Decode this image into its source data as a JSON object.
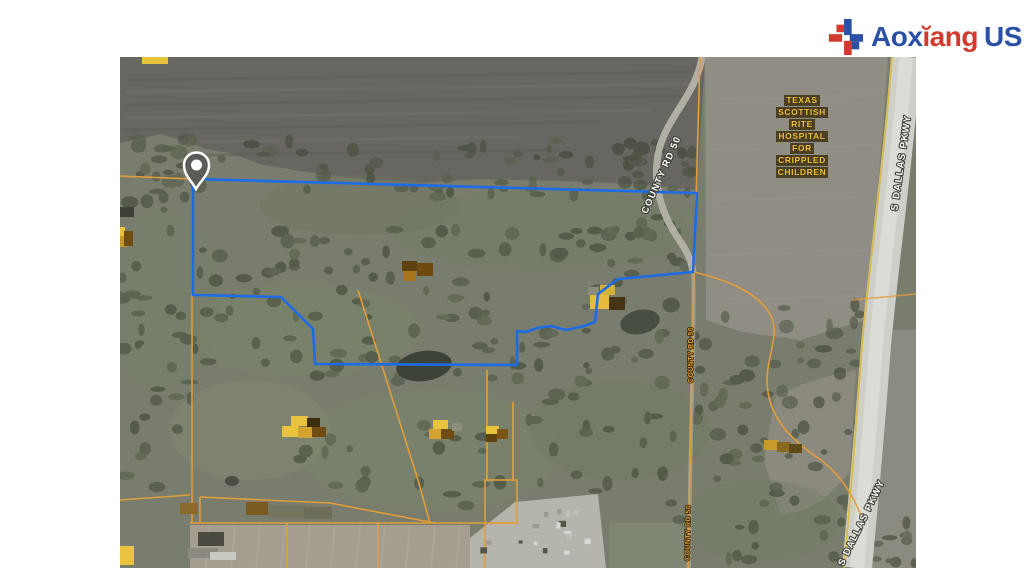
{
  "logo": {
    "part1": "Aox",
    "part2": "ĭang",
    "part3": "US"
  },
  "colors": {
    "brand_blue": "#2a51a5",
    "brand_red": "#d23a2e",
    "boundary_blue": "#1b6ce6",
    "parcel_orange": "#e29e3a",
    "label_yellow": "#f2c238"
  },
  "map": {
    "labels": {
      "hospital_lines": [
        "TEXAS",
        "SCOTTISH",
        "RITE",
        "HOSPITAL",
        "FOR",
        "CRIPPLED",
        "CHILDREN"
      ],
      "county_road_top": "COUNTY RD 50",
      "county_road_mid": "COUNTY RD 50",
      "county_road_bottom": "COUNTY RD 50",
      "dallas_pkwy_top": "S DALLAS PKWY",
      "dallas_pkwy_bottom": "S DALLAS PKWY"
    }
  }
}
